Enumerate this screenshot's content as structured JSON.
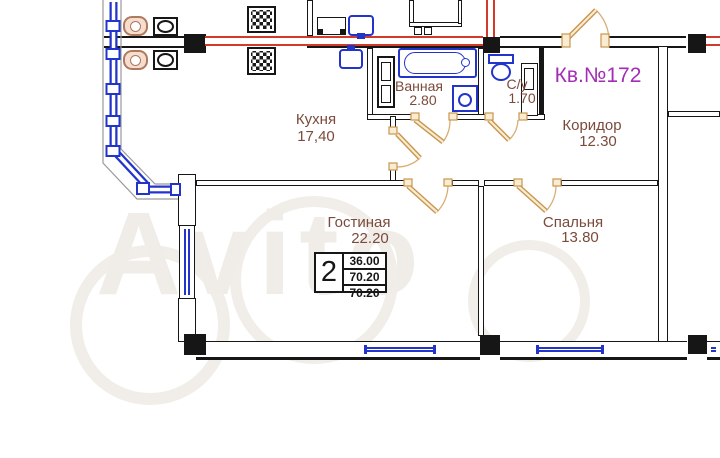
{
  "apartment": {
    "number_label": "Кв.№172"
  },
  "rooms": {
    "kitchen": {
      "name": "Кухня",
      "area": "17,40"
    },
    "bathroom": {
      "name": "Ванная",
      "area": "2.80"
    },
    "wc": {
      "name": "С/у",
      "area": "1.70"
    },
    "corridor": {
      "name": "Коридор",
      "area": "12.30"
    },
    "living": {
      "name": "Гостиная",
      "area": "22.20"
    },
    "bedroom": {
      "name": "Спальня",
      "area": "13.80"
    }
  },
  "stamp": {
    "rooms_count": "2",
    "area_living": "36.00",
    "area_total": "70.20",
    "area_total_with_balcony": "70.20"
  },
  "watermark": {
    "text": "Avito"
  },
  "colors": {
    "walls": "#161616",
    "heating_pipe": "#d33a2c",
    "plumbing": "#2334cb",
    "doors": "#c9964f",
    "room_label": "#7b4a3b",
    "apartment_label": "#a32db6"
  }
}
